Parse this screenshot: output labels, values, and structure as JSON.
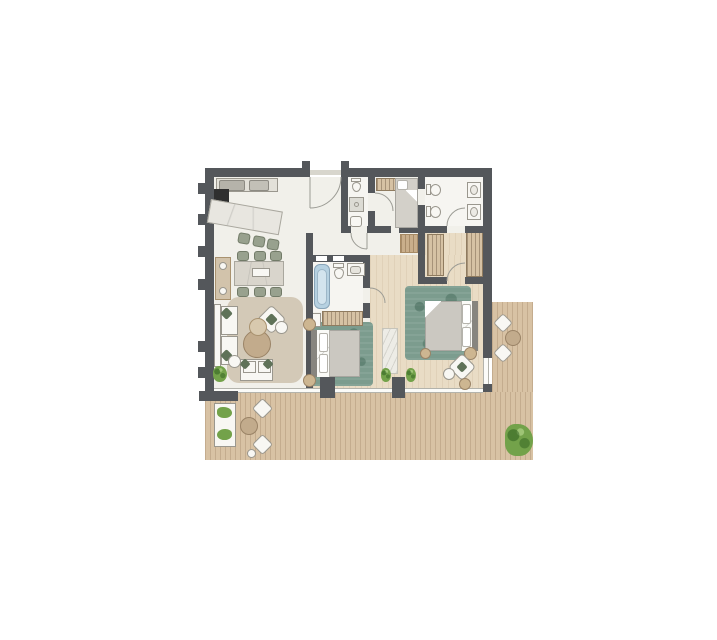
{
  "meta": {
    "image_type": "architectural floor plan, top-down rendered view",
    "subject": "two/three-bedroom apartment with L-shaped wraparound wood terrace",
    "visible_text": "none"
  },
  "palette": {
    "wall": "#54575b",
    "cream": "#f1f0ea",
    "room_white": "#f6f5f1",
    "wood": "#e9dcc5",
    "deck": "#d8c2a4",
    "rug_green": "#7c9c8e",
    "rug_beige": "#d3c9b7",
    "tan": "#c2ab8c",
    "tan_light": "#d8c9ae",
    "sage": "#98a18e",
    "sage_dark": "#5f7258",
    "furn": "#f8f7f3",
    "outline": "#9a978e",
    "tub": "#b6d1e1",
    "tub_inner": "#d3e4ee",
    "plant": "#73a24a",
    "runner": "#edece6",
    "hallrug": "#c9ae8b",
    "wardrobe": "#d6c2a4",
    "appliance_dark": "#2f2f2f",
    "duvet": "#cbc8c1",
    "headboard": "#87857f",
    "glass": "#fbfbf8",
    "threshold": "#d8d6cd",
    "metal": "#b5b3aa"
  },
  "rooms": [
    {
      "name": "kitchen",
      "items": [
        "wall counter with cooktop and sink",
        "dark oven/appliance block",
        "angled marble island",
        "3 bar stools"
      ]
    },
    {
      "name": "dining-area",
      "items": [
        "rectangular table with centerpiece",
        "6 sage-green chairs",
        "wall console with 2 round trays"
      ]
    },
    {
      "name": "living-room",
      "items": [
        "beige area rug",
        "white sofa with 2 green pillows",
        "two-seat loveseat",
        "rotated accent armchair",
        "two round nesting coffee tables",
        "2 round side tables",
        "potted plant"
      ]
    },
    {
      "name": "entry-hall",
      "items": [
        "entrance door with swing arc",
        "tan runner rug"
      ]
    },
    {
      "name": "guest-wc",
      "items": [
        "toilet",
        "shower square",
        "washbasin"
      ]
    },
    {
      "name": "small-bedroom",
      "items": [
        "single bed with white pillow",
        "built-in wardrobe strip"
      ]
    },
    {
      "name": "central-bathroom",
      "items": [
        "bathtub",
        "toilet",
        "vanity with sink",
        "two wall niches"
      ]
    },
    {
      "name": "bedroom-1",
      "items": [
        "green mottled rug",
        "double bed with headboard left",
        "2 round nightstands",
        "wardrobe row with hangers",
        "white cabinet"
      ]
    },
    {
      "name": "walk-in-closet",
      "items": [
        "left wardrobe unit",
        "right wardrobe unit"
      ]
    },
    {
      "name": "master-bathroom",
      "items": [
        "toilet",
        "bidet",
        "2 washbasins"
      ]
    },
    {
      "name": "master-bedroom",
      "items": [
        "green mottled rug",
        "double bed with headboard right",
        "round nightstands",
        "rotated desk chair with 2 round stools",
        "marble runner in hallway"
      ]
    },
    {
      "name": "terrace",
      "items": [
        "vertical lounge sofa with green cushions",
        "round coffee table",
        "3 rotated lounge chairs",
        "small ottoman",
        "round side table",
        "2 window-side shrubs",
        "large corner bush",
        "plank decking"
      ]
    }
  ],
  "windows": {
    "south_glazing": "full-width window band with 2 piers",
    "east_glazing": "corner window",
    "west_wall_stubs": 6
  }
}
